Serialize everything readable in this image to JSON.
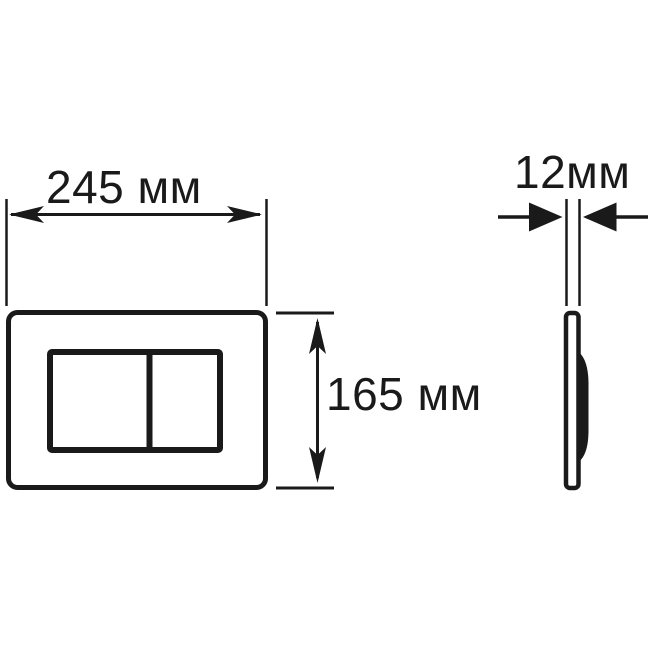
{
  "colors": {
    "background": "#ffffff",
    "ink": "#1a1a1a"
  },
  "drawing": {
    "kind": "technical-dimension-drawing",
    "dimensions": {
      "width": {
        "value": 245,
        "unit": "мм",
        "label": "245 мм"
      },
      "height": {
        "value": 165,
        "unit": "мм",
        "label": "165 мм"
      },
      "depth": {
        "value": 12,
        "unit": "мм",
        "label": "12мм"
      }
    }
  }
}
